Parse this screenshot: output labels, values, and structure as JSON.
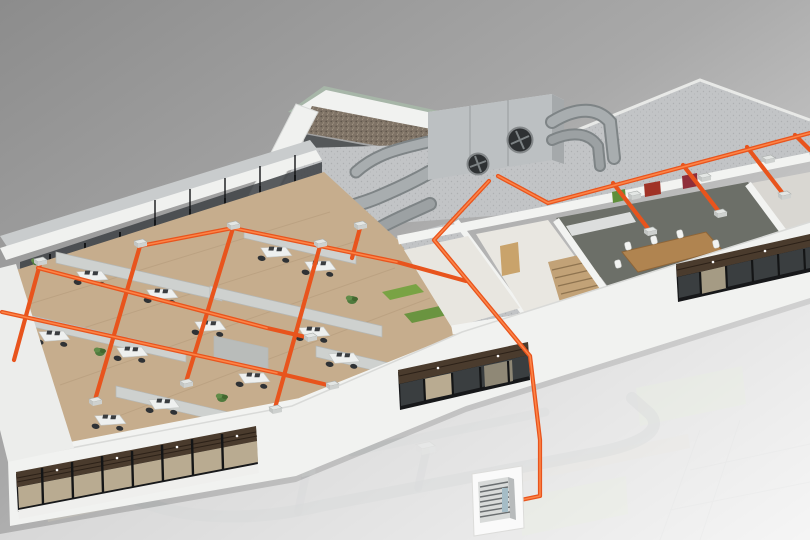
{
  "meta": {
    "description": "3D isometric cutaway rendering of a two-storey office building showing a rooftop air-handling unit and an orange ventilation duct network; the lower storey is ghosted white with a wall-mounted control panel connected by an orange riser.",
    "canvas": {
      "width": 810,
      "height": 540
    }
  },
  "colors": {
    "background_top": "#8e8e8e",
    "background_bottom": "#eaeaea",
    "building_white": "#f1f2f0",
    "roof_concrete": "#c2c4c6",
    "penthouse_wall_dark": "#545759",
    "gravel_brown": "#7f7366",
    "green_roof_edge": "#a7b6a8",
    "ahu_body": "#bcc0c2",
    "duct_metal": "#9ca1a3",
    "duct_orange": "#e8541d",
    "duct_orange_highlight": "#ff8a4d",
    "office_floor_wood": "#c6ad8d",
    "cabinet_gray": "#ced1cf",
    "chair_dark": "#2f3235",
    "plant_green": "#4f7a3d",
    "planter_green": "#79a344",
    "carpet_dark": "#6c6f68",
    "table_wood": "#b08450",
    "stair_wood": "#c2a277",
    "door_wood": "#c9a36b",
    "window_frame_black": "#17181a",
    "louver_brown": "#4a3b2d",
    "glass_tan": "#b9ab91",
    "glass_dark": "#3a3e40",
    "art_red": "#a03226",
    "art_green": "#5f8f3a",
    "ghost_gray": "#a8adaf",
    "ghost_green_glass": "#d4e2bf",
    "panel_body": "#d8dad9",
    "panel_accent": "#a5bcc6"
  },
  "scene": {
    "type": "isometric-cutaway-render",
    "upper_floor": {
      "open_office": {
        "floor": "wood",
        "desk_clusters": 12,
        "partition_rows": 6,
        "plants": 6,
        "planter_boxes": 2
      },
      "rooms": [
        "open office",
        "corridor",
        "stair room",
        "conference room",
        "kitchenette"
      ],
      "conference_room": {
        "chairs": 8,
        "artworks": 3,
        "carpet": "dark"
      },
      "stair_room": {
        "steps": 5,
        "wood_door": true
      },
      "facade_window_bands": 3
    },
    "rooftop": {
      "air_handling_unit": {
        "fans": 2
      },
      "gravel_roof_strip": true,
      "green_roof_edge": true,
      "metal_supply_ducts": 5
    },
    "duct_network": {
      "color_hex": "#e8541d",
      "office_rails": 3,
      "office_cross_runs": 4,
      "right_wing_branches": 4,
      "ceiling_diffusers": 12,
      "riser_to_lower_floor": true
    },
    "lower_floor": {
      "ghosted": true,
      "duct_run_visible": true,
      "green_glass_partitions": 2,
      "control_panel": {
        "slats": 7,
        "mounted_on": "white backboard"
      }
    }
  }
}
